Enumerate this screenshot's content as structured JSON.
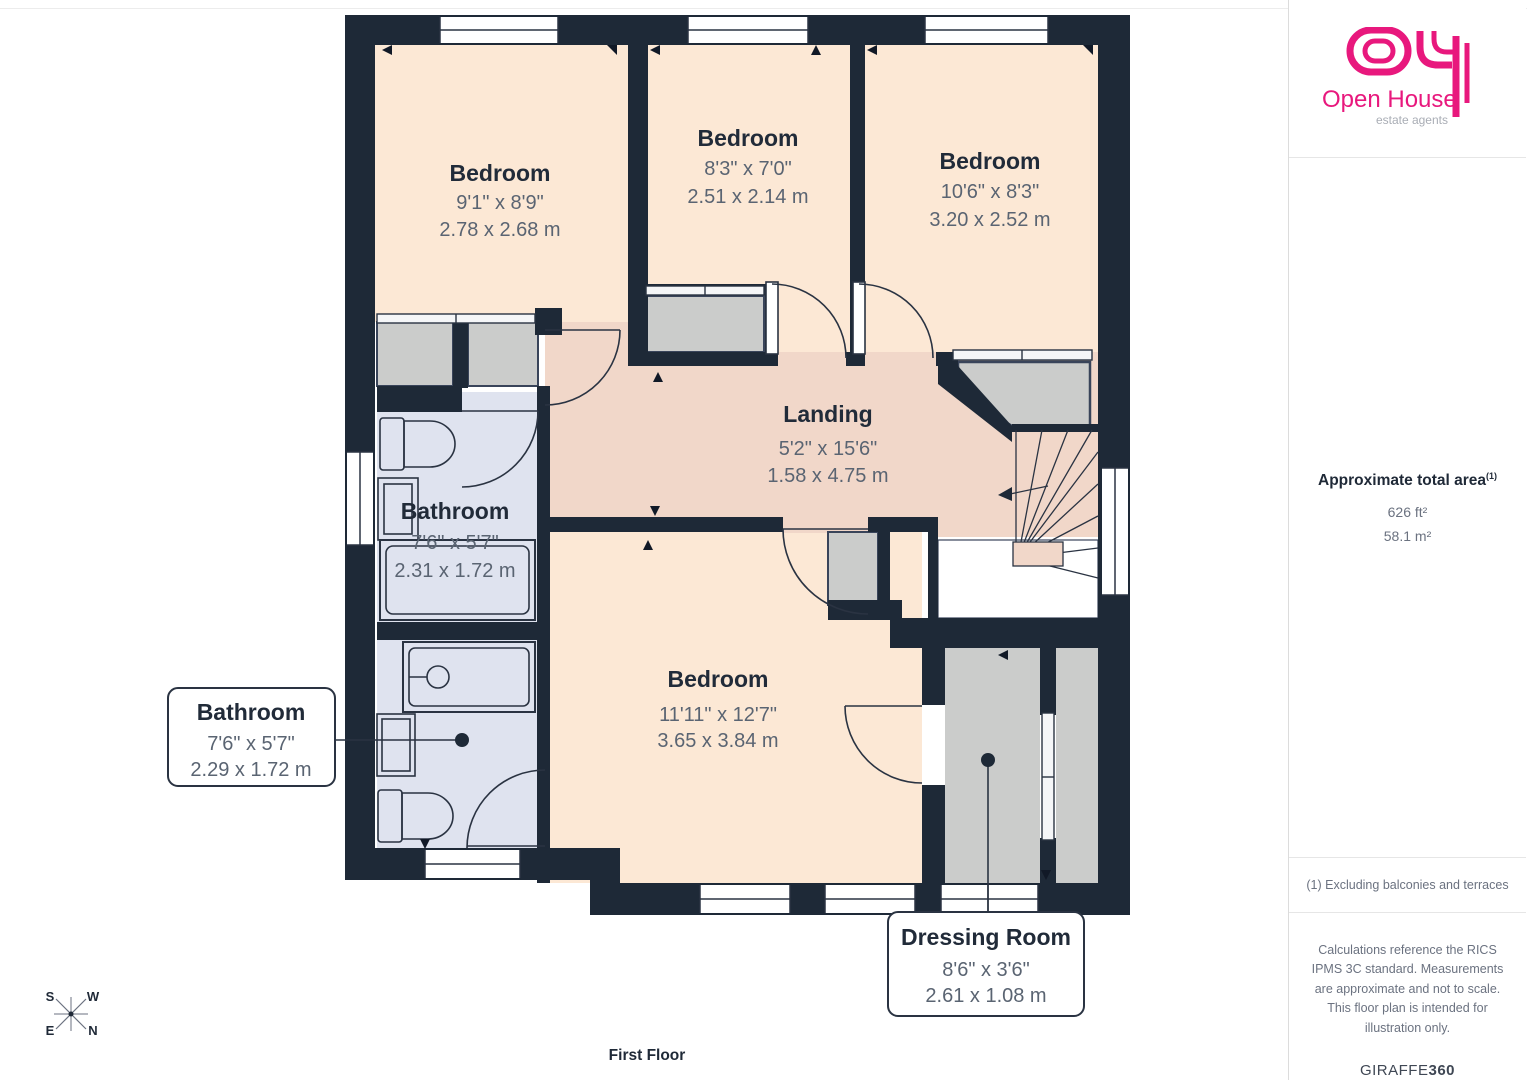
{
  "floorplan": {
    "floor_label": "First Floor",
    "rooms": [
      {
        "name": "Bedroom",
        "imperial": "9'1\" x 8'9\"",
        "metric": "2.78 x 2.68 m"
      },
      {
        "name": "Bedroom",
        "imperial": "8'3\" x 7'0\"",
        "metric": "2.51 x 2.14 m"
      },
      {
        "name": "Bedroom",
        "imperial": "10'6\" x 8'3\"",
        "metric": "3.20 x 2.52 m"
      },
      {
        "name": "Landing",
        "imperial": "5'2\" x 15'6\"",
        "metric": "1.58 x 4.75 m"
      },
      {
        "name": "Bathroom",
        "imperial": "7'6\" x 5'7\"",
        "metric": "2.31 x 1.72 m"
      },
      {
        "name": "Bedroom",
        "imperial": "11'11\" x 12'7\"",
        "metric": "3.65 x 3.84 m"
      }
    ],
    "callouts": [
      {
        "name": "Bathroom",
        "imperial": "7'6\" x 5'7\"",
        "metric": "2.29 x 1.72 m"
      },
      {
        "name": "Dressing Room",
        "imperial": "8'6\" x 3'6\"",
        "metric": "2.61 x 1.08 m"
      }
    ],
    "compass": {
      "nw": "S",
      "ne": "W",
      "sw": "E",
      "se": "N"
    }
  },
  "sidebar": {
    "logo": {
      "brand": "Open House",
      "tagline": "estate agents"
    },
    "area": {
      "heading": "Approximate total area",
      "note_ref": "(1)",
      "imperial": "626 ft²",
      "metric": "58.1 m²"
    },
    "footnote": "(1) Excluding balconies and terraces",
    "disclaimer": "Calculations reference the RICS IPMS 3C standard. Measurements are approximate and not to scale. This floor plan is intended for illustration only.",
    "credit": {
      "brand": "GIRAFFE",
      "suffix": "360"
    }
  },
  "colors": {
    "wall": "#1e2937",
    "bedroom_floor": "#fce8d5",
    "landing_floor": "#f1d7c9",
    "bathroom_floor": "#dfe3ef",
    "closet_gray": "#cbcccb",
    "logo_pink": "#e8187d"
  }
}
